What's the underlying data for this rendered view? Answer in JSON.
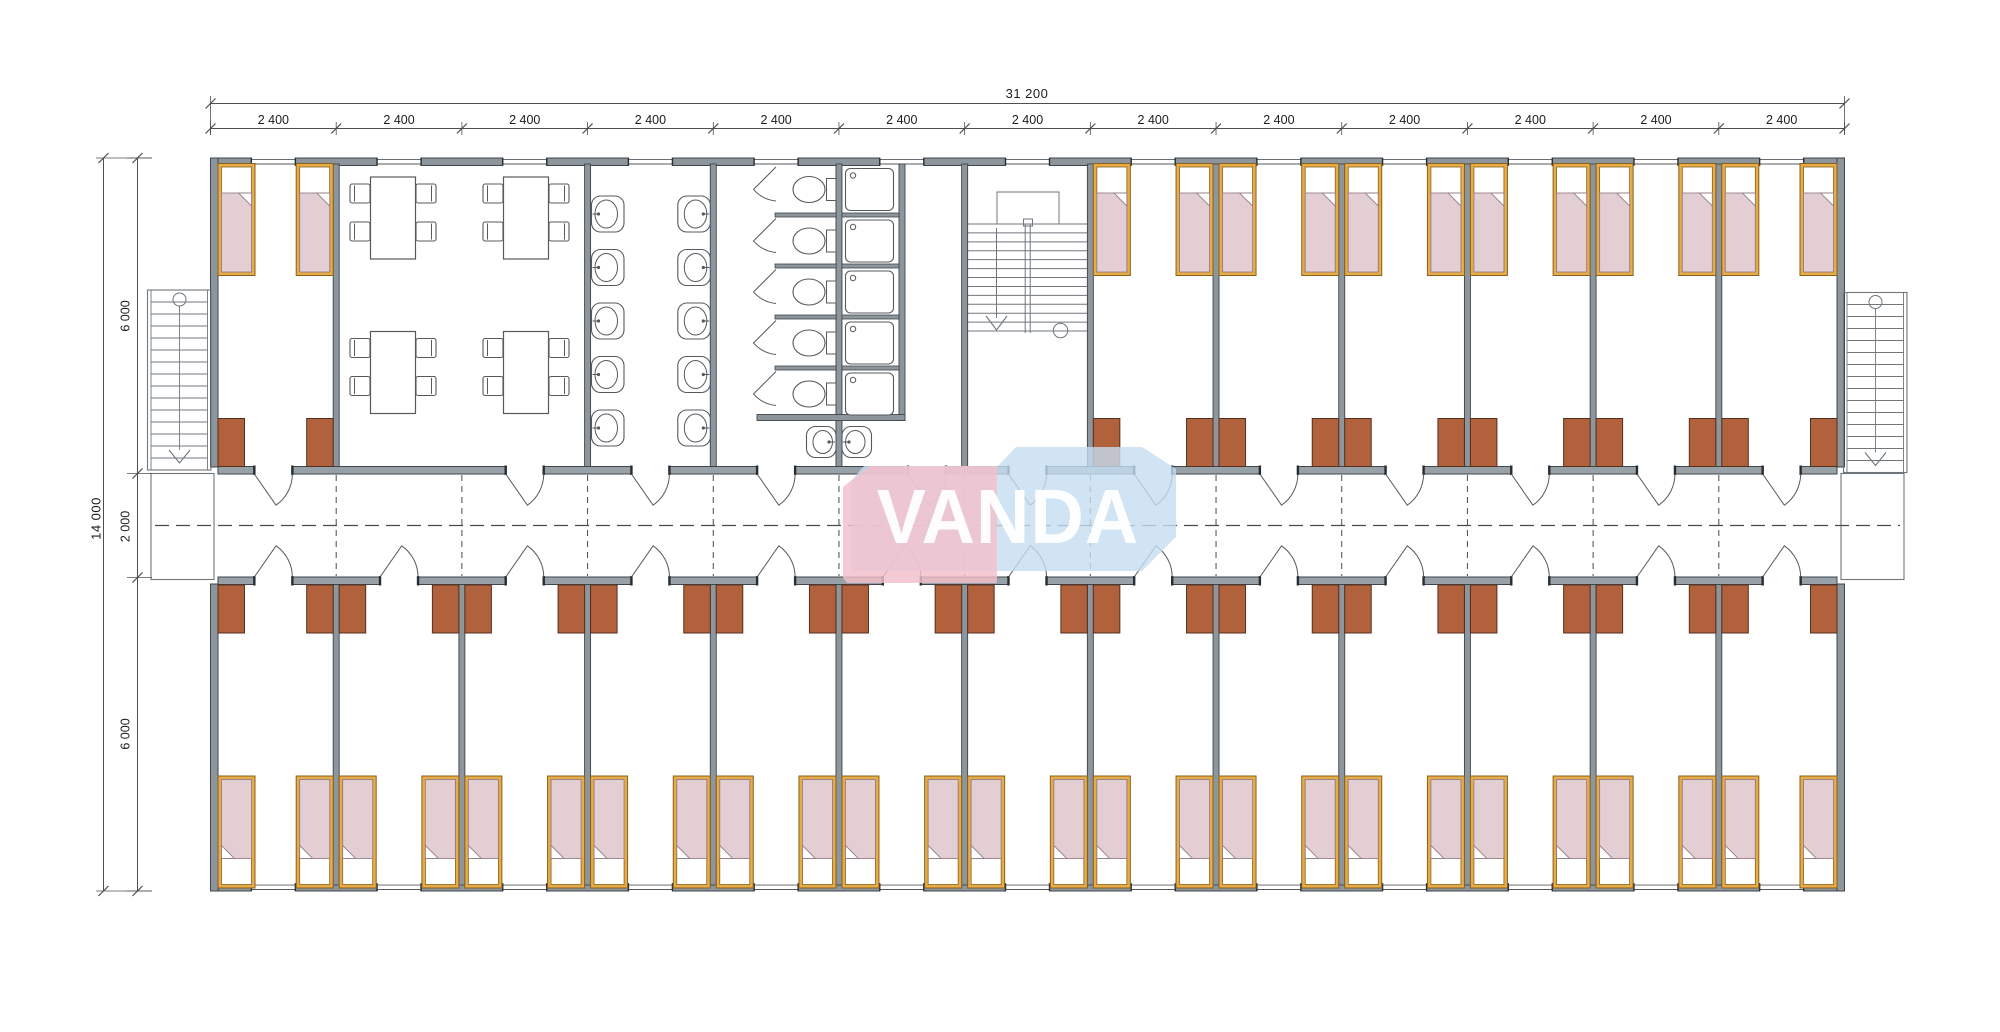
{
  "watermark": {
    "text": "VANDA",
    "pink_color": "#f2c0ca",
    "blue_color": "#c6ddf1",
    "text_color": "#ffffff"
  },
  "dimensions": {
    "total_width_label": "31 200",
    "module_width_label": "2 400",
    "module_count": 13,
    "total_height_label": "14 000",
    "left_segment_labels": [
      "6 000",
      "2 000",
      "6 000"
    ]
  },
  "layout": {
    "x0": 210.5,
    "x1": 1844.5,
    "yTop": 158,
    "yCorTop": 474,
    "yCorBot": 577,
    "yBot": 891,
    "modules": 13
  },
  "colors": {
    "wall": "#8d969d",
    "wallLight": "#98a1a8",
    "wallEdge": "#3f454a",
    "cap": "#272c30",
    "line": "#555a5f",
    "thin": "#6f767c",
    "dash": "#4a4a4a",
    "bedFrame": "#e9ab45",
    "bedFrameEdge": "#86621f",
    "pillow": "#ffffff",
    "blanket": "#e3ced4",
    "blanketEdge": "#968188",
    "desk": "#b2613d",
    "deskEdge": "#55301c",
    "dimText": "#1c1c1c",
    "dimLine": "#4f4f4f",
    "paper": "#ffffff"
  },
  "rooms": {
    "top": [
      {
        "modules": [
          1
        ],
        "type": "bedroom",
        "beds": 2,
        "desks": 2
      },
      {
        "modules": [
          2,
          3
        ],
        "type": "dining",
        "tables": 4,
        "chairs_per_table": 4
      },
      {
        "modules": [
          4
        ],
        "type": "washroom",
        "sinks": 10
      },
      {
        "modules": [
          5
        ],
        "type": "toilets",
        "stalls": 5,
        "toilets": 5
      },
      {
        "modules": [
          6
        ],
        "type": "showers",
        "stalls": 5,
        "extra_sinks": 2
      },
      {
        "modules": [
          7
        ],
        "type": "stairwell",
        "flights": 2
      },
      {
        "modules": [
          8,
          9,
          10,
          11,
          12,
          13
        ],
        "type": "bedrooms",
        "beds": 12,
        "desks": 12
      }
    ],
    "bottom": [
      {
        "modules": [
          1,
          13
        ],
        "type": "bedrooms",
        "beds": 26,
        "desks": 26
      }
    ],
    "corridor": {
      "type": "corridor",
      "external_stairs": 2,
      "landings": 2
    }
  },
  "doors": {
    "width": 38,
    "top_door_modules": [
      1,
      3,
      4,
      5,
      6,
      7,
      8,
      9,
      10,
      11,
      12,
      13
    ],
    "top_center_override": {
      "6": 927
    },
    "bottom_door_modules": [
      1,
      2,
      3,
      4,
      5,
      6,
      7,
      8,
      9,
      10,
      11,
      12,
      13
    ]
  },
  "windows": {
    "width": 44
  }
}
